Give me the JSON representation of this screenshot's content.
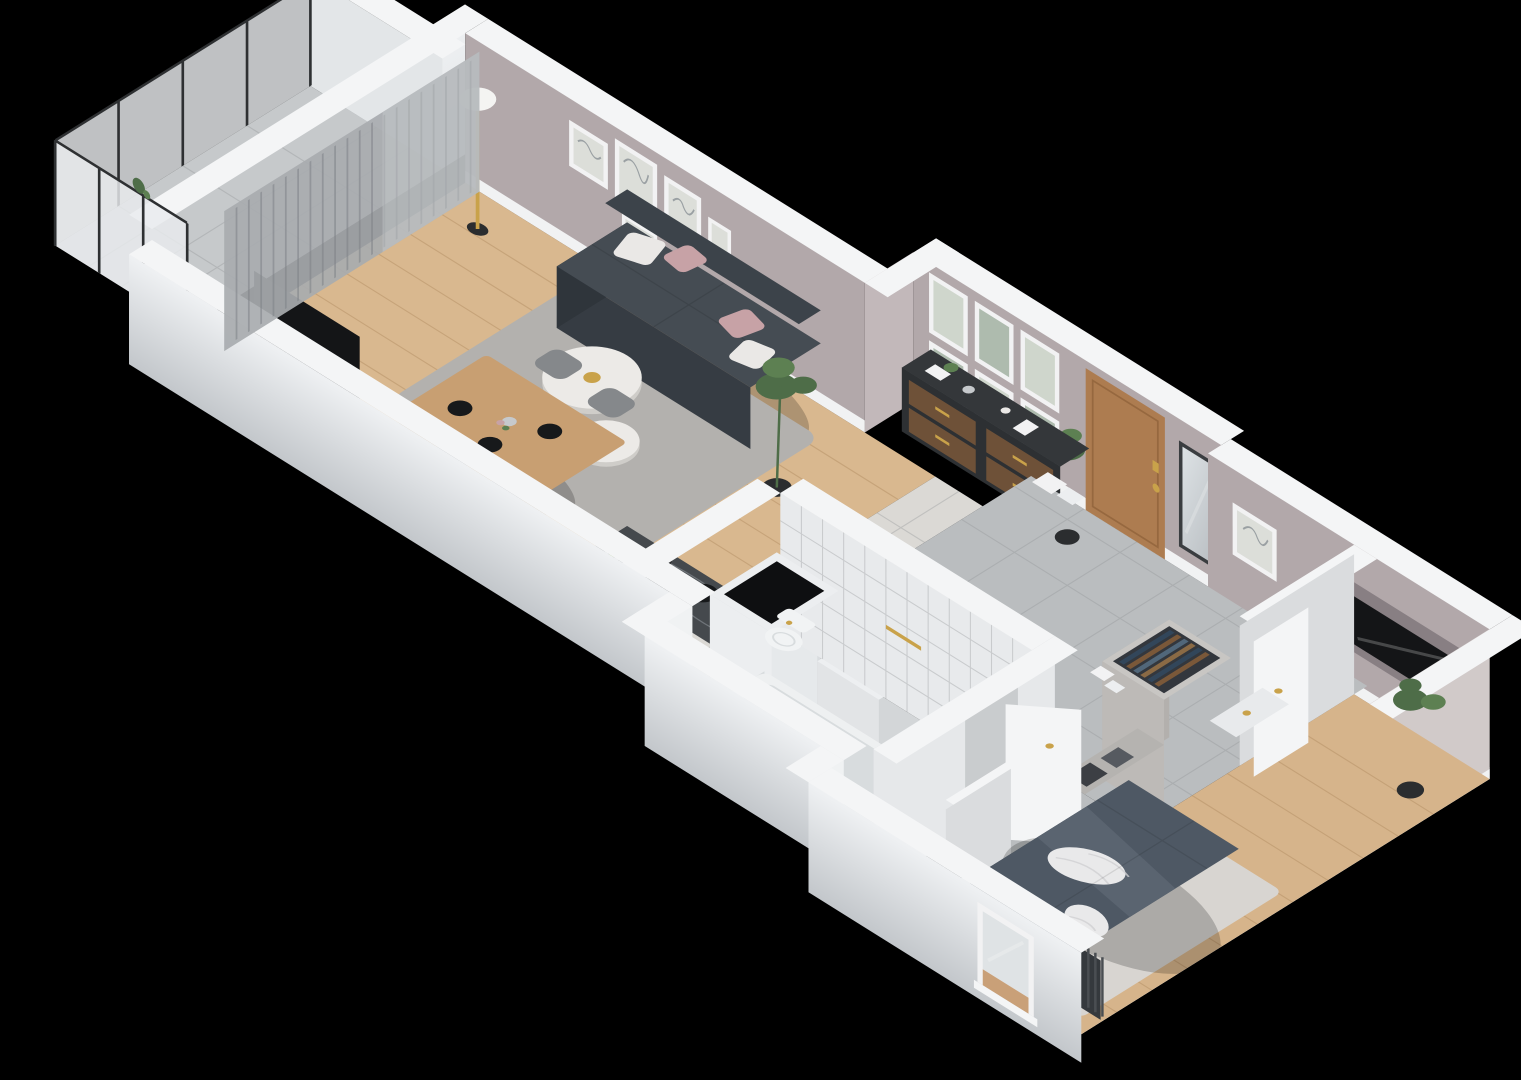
{
  "scene": {
    "title": "isometric-3d-apartment-floor-plan",
    "style": "cutaway 3D render on black background",
    "background": "#000000"
  },
  "rooms": [
    {
      "name": "balcony",
      "floor": "gray tile",
      "features": [
        "frosted-glass-balustrade",
        "metal-rail",
        "rail-plant"
      ]
    },
    {
      "name": "living-room",
      "floor": "light oak wood",
      "features": [
        "curtained-window-wall",
        "gallery-wall-art",
        "sofa",
        "rug",
        "coffee-tables",
        "dining-table",
        "floor-lamp",
        "tv-wall",
        "sideboard",
        "plants"
      ]
    },
    {
      "name": "kitchen",
      "floor": "light tile",
      "features": [
        "dark-marble-counter",
        "cooktop",
        "sink",
        "fridge-with-freezer-top",
        "wine-rack",
        "shelf-unit"
      ]
    },
    {
      "name": "bathroom",
      "floor": "marble",
      "features": [
        "wall-hung-toilet",
        "bathtub",
        "washing-machine",
        "white-tile-walls"
      ]
    },
    {
      "name": "hallway",
      "floor": "large gray tiles",
      "features": [
        "entrance-door",
        "wall-mirror",
        "frame-grid-art",
        "storage-boxes"
      ]
    },
    {
      "name": "wardrobe-corridor",
      "features": [
        "open-wardrobes-with-clothes",
        "cabinet",
        "open-doors"
      ]
    },
    {
      "name": "bedroom",
      "floor": "light oak wood",
      "features": [
        "double-bed",
        "carpet",
        "tv-niche",
        "radiators",
        "window",
        "plant",
        "bedside-shelf",
        "wall-art"
      ]
    }
  ],
  "furniture": [
    "sofa",
    "coffee-table-large",
    "coffee-table-small",
    "dining-table",
    "dining-chairs",
    "floor-lamp",
    "tv-panel",
    "tv-lowboard",
    "sideboard",
    "kitchen-counter",
    "fridge",
    "wine-rack",
    "shelf-boxes",
    "bathtub",
    "toilet",
    "washing-machine",
    "wardrobe-rack",
    "cabinet",
    "double-bed",
    "radiator",
    "mirror",
    "entrance-door",
    "open-door-leaf"
  ],
  "icons": {
    "freezer_snowflake": "six-spoke snowflake on fridge top"
  },
  "colors": {
    "background": "#000000",
    "wallTopCap": "#f4f5f6",
    "wallOuterLight": "#eff1f3",
    "wallOuterDark": "#c3c7cb",
    "wallOuterMid": "#e3e6e8",
    "stepBright": "#f0f2f3",
    "wallPink": "#b2a8aa",
    "wallPinkStep": "#c2b8ba",
    "wallEnd": "#d1cac9",
    "skirting": "#f1f2f3",
    "woodFloor": "#d9b88f",
    "woodBedroom": "#d6b48b",
    "tileKitchen": "#dbd9d5",
    "tileHall": "#babdbf",
    "balconyFloor": "#c6c9cb",
    "glassFrost": "#e9ecee",
    "railDark": "#2e3032",
    "curtain": "#a8abaf",
    "sheer": "#c6c9cc",
    "rug": "#b3b1ae",
    "sofaTop": "#454c53",
    "sofaFront": "#363c43",
    "sofaSide": "#2f353b",
    "sofaCushion": "#3c434a",
    "pillowWhite": "#eae8e6",
    "pillowPink": "#c7a2a6",
    "tableWood": "#c89f72",
    "chairGray": "#85888b",
    "coffeeTop": "#eceae7",
    "coffeeSide": "#cfcdc9",
    "lampGold": "#c9a24a",
    "lampGlobe": "#f4f4f2",
    "tvPanel": "#141517",
    "tvUnit": "#1b1d1f",
    "plantGreen": "#4e6d48",
    "plantGreenLight": "#5d8052",
    "potDark": "#2b2d2f",
    "sideboardBody": "#2d3033",
    "sideboardTop": "#34373a",
    "drawerWood": "#6e5138",
    "gold": "#c9a24a",
    "counterTop": "#45494d",
    "counterSide": "#34383c",
    "sinkDark": "#2b2f33",
    "hobBlack": "#17191b",
    "appleGreen": "#76a83d",
    "fridgeTop": "#f0f2f3",
    "fridgeFace": "#e6e9eb",
    "fridgeSide": "#d9dcdf",
    "snowflake": "#3e4346",
    "wineTop": "#b9b6b3",
    "wineSide": "#a7a4a1",
    "bottleBrown": "#5d3f27",
    "shelfTop": "#edeff1",
    "shelfFace": "#e2e4e6",
    "shelfSide": "#d6d9db",
    "boxBlue": "#7fb3d1",
    "bathTile": "#e8eaec",
    "bathFloor": "#d3d6d8",
    "tubWhite": "#eef0f1",
    "tubInner": "#d8dcde",
    "toiletWhite": "#f1f3f4",
    "washerBlack": "#0e0f11",
    "washerBox": "#eceef0",
    "hallWall": "#e6e8ea",
    "doorwayBack": "#c9ccce",
    "doorWood": "#ad7c50",
    "doorWoodDark": "#96683f",
    "mirrorFrame": "#3a3d40",
    "mirrorGlassA": "#dde2e5",
    "mirrorGlassB": "#b8bdc1",
    "frameWhite": "#f2f2f3",
    "artSketch": "#dcded9",
    "artGreenA": "#cfd6cc",
    "artGreenB": "#aebbae",
    "nicheDark": "#887f83",
    "wardrobeTop": "#c8c6c3",
    "wardrobeInner": "#33373d",
    "wardrobeFace": "#bdbab7",
    "wardrobeSide": "#b3b0ad",
    "clothesNavy": "#32465a",
    "clothesSteel": "#51677a",
    "clothesBrown": "#7a5839",
    "clothesTan": "#8a6a45",
    "cabinetGray": "#b5b3b0",
    "boxDark": "#3c3f44",
    "boxMid": "#565a60",
    "stubFace": "#dadcde",
    "carpet": "#d8d5d1",
    "duvet": "#4e5864",
    "duvetLight": "#5a6470",
    "bedFront": "#3f4854",
    "bedSide": "#37404b",
    "blanketWhite": "#e9e9ea",
    "radiator": "#35393d",
    "benchWhite": "#e8eaec",
    "windowGlass": "#dfe3e5",
    "windowWood": "#c9a078",
    "doorLeaf": "#f4f5f6"
  }
}
